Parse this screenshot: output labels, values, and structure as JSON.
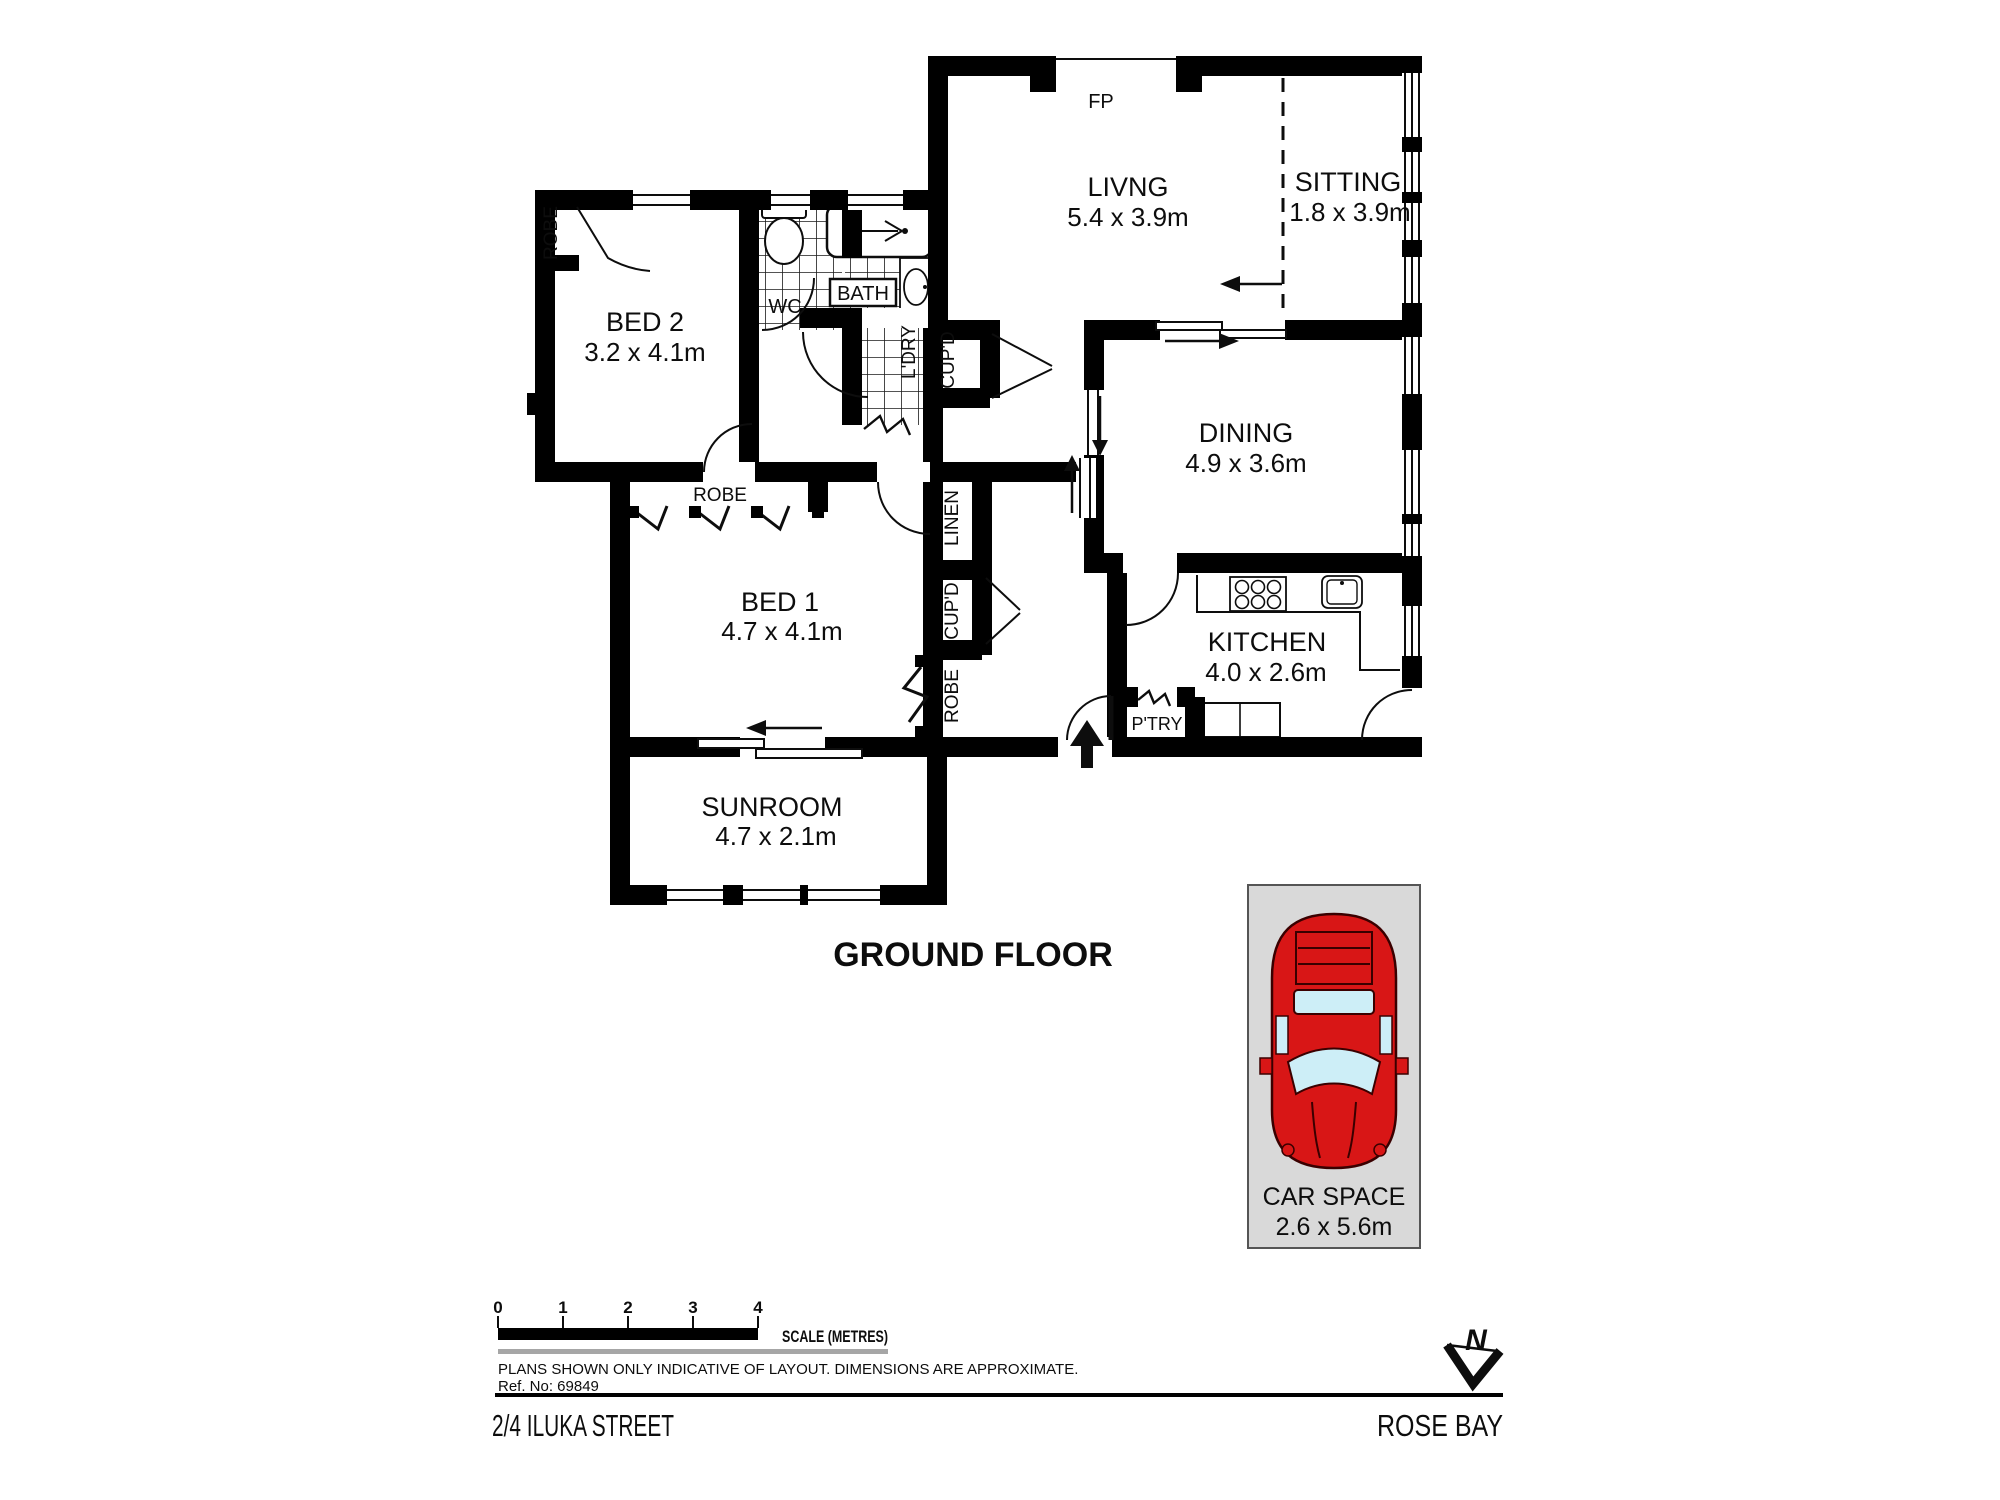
{
  "title": {
    "floor": "GROUND FLOOR"
  },
  "rooms": {
    "living": {
      "name": "LIVNG",
      "dims": "5.4 x 3.9m"
    },
    "sitting": {
      "name": "SITTING",
      "dims": "1.8 x 3.9m"
    },
    "dining": {
      "name": "DINING",
      "dims": "4.9 x 3.6m"
    },
    "kitchen": {
      "name": "KITCHEN",
      "dims": "4.0 x 2.6m"
    },
    "bed1": {
      "name": "BED 1",
      "dims": "4.7 x 4.1m"
    },
    "bed2": {
      "name": "BED 2",
      "dims": "3.2 x 4.1m"
    },
    "sunroom": {
      "name": "SUNROOM",
      "dims": "4.7 x 2.1m"
    }
  },
  "labels": {
    "fp": "FP",
    "wc": "WC",
    "bath": "BATH",
    "ldry": "L'DRY",
    "cupd_bath": "CUP'D",
    "robe_bed2": "ROBE",
    "robe_bed1": "ROBE",
    "linen": "LINEN",
    "cupd_hall": "CUP'D",
    "robe_hall": "ROBE",
    "ptry": "P'TRY"
  },
  "car_space": {
    "name": "CAR SPACE",
    "dims": "2.6 x 5.6m"
  },
  "scale": {
    "ticks": [
      "0",
      "1",
      "2",
      "3",
      "4"
    ],
    "label": "SCALE (METRES)"
  },
  "notes": {
    "disclaimer": "PLANS SHOWN ONLY INDICATIVE OF LAYOUT.  DIMENSIONS ARE APPROXIMATE.",
    "ref": "Ref. No: 69849"
  },
  "footer": {
    "address": "2/4 ILUKA STREET",
    "suburb": "ROSE BAY"
  },
  "compass": {
    "north": "N"
  },
  "colors": {
    "wall": "#000000",
    "car_red": "#d81616",
    "glass_blue": "#cdeef7",
    "space_grey": "#d9d9d9"
  }
}
